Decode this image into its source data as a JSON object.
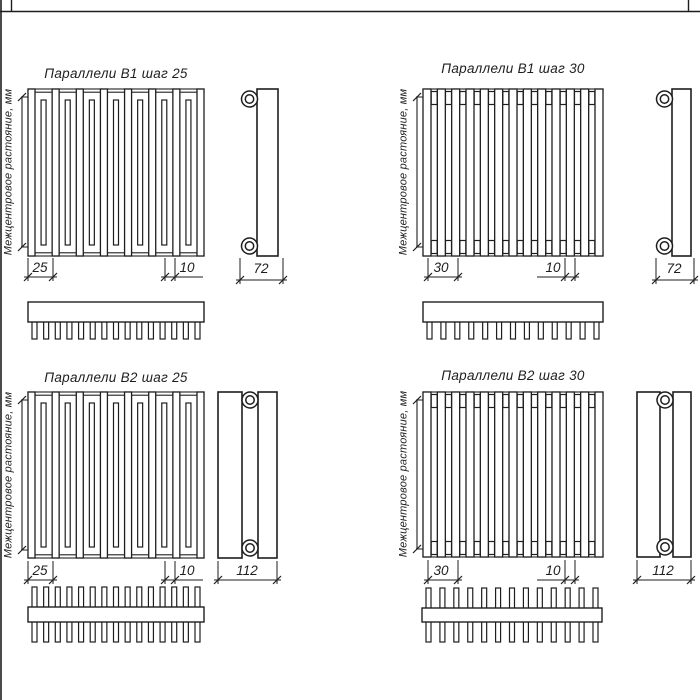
{
  "drawing": {
    "background": "#ffffff",
    "line_color": "#1e1e1e",
    "axis_label": "Межцентровое растояние, мм",
    "quadrants": [
      {
        "title": "Параллели В1 шаг 25",
        "pitch": "25",
        "tube_width": "10",
        "depth": "72"
      },
      {
        "title": "Параллели В1 шаг 30",
        "pitch": "30",
        "tube_width": "10",
        "depth": "72"
      },
      {
        "title": "Параллели В2 шаг 25",
        "pitch": "25",
        "tube_width": "10",
        "depth": "112"
      },
      {
        "title": "Параллели В2 шаг 30",
        "pitch": "30",
        "tube_width": "10",
        "depth": "112"
      }
    ]
  }
}
